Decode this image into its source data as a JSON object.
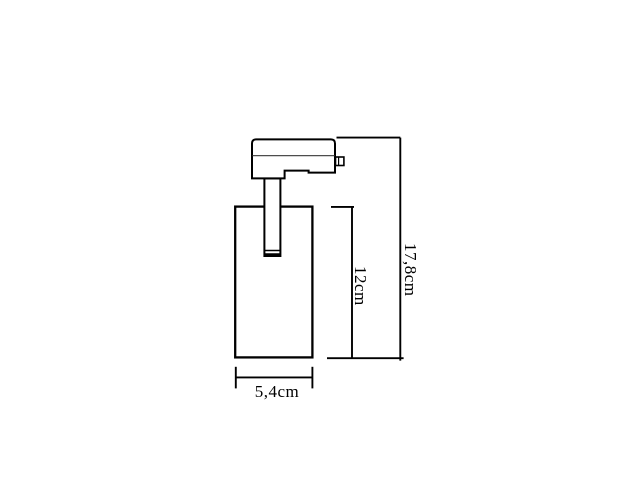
{
  "diagram": {
    "type": "technical-dimension-drawing",
    "subject": "track-spotlight-side-view",
    "labels": {
      "total_height": "17,8cm",
      "body_height": "12cm",
      "body_width": "5,4cm"
    },
    "colors": {
      "background": "#ffffff",
      "line": "#000000",
      "divider_line": "#4d4d4d"
    }
  }
}
